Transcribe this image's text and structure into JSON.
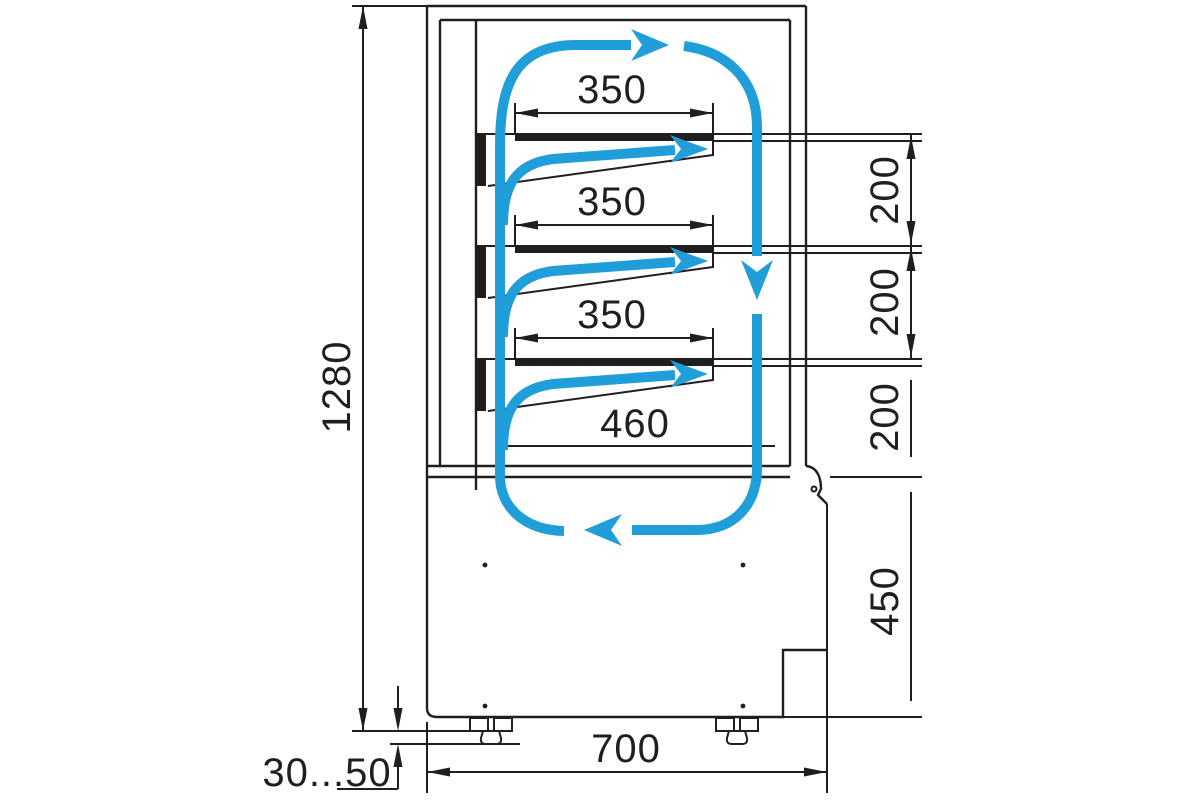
{
  "labels": {
    "overall_height": "1280",
    "shelf_width_1": "350",
    "shelf_width_2": "350",
    "shelf_width_3": "350",
    "bottom_shelf_width": "460",
    "gap_1": "200",
    "gap_2": "200",
    "gap_3": "200",
    "base_height": "450",
    "depth": "700",
    "leg_height_range": "30...50"
  },
  "colors": {
    "line": "#1f1f1f",
    "flow": "#1f9ed9",
    "background": "#ffffff"
  }
}
